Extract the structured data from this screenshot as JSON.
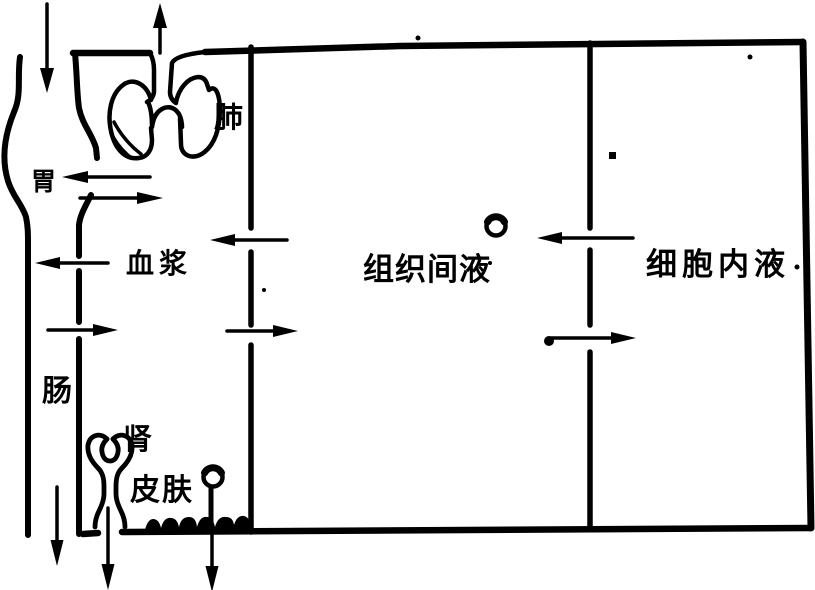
{
  "diagram": {
    "colors": {
      "ink": "#000000",
      "background": "#ffffff"
    },
    "compartments": [
      {
        "id": "plasma",
        "label": "血浆"
      },
      {
        "id": "interstitial",
        "label": "组织间液"
      },
      {
        "id": "intracellular",
        "label": "细胞内液"
      }
    ],
    "organs": [
      {
        "id": "lung",
        "label": "肺"
      },
      {
        "id": "stomach",
        "label": "胃"
      },
      {
        "id": "intestine",
        "label": "肠"
      },
      {
        "id": "kidney",
        "label": "肾"
      },
      {
        "id": "skin",
        "label": "皮肤"
      }
    ],
    "flows": [
      {
        "name": "ingestion",
        "from": "outside",
        "to": "digestive-tract",
        "direction": "down"
      },
      {
        "name": "exhalation",
        "from": "lung",
        "to": "outside",
        "direction": "up"
      },
      {
        "name": "secretion-into-stomach",
        "from": "plasma",
        "to": "stomach",
        "direction": "left"
      },
      {
        "name": "absorption-from-stomach",
        "from": "stomach",
        "to": "plasma",
        "direction": "right"
      },
      {
        "name": "secretion-into-intestine",
        "from": "plasma",
        "to": "intestine",
        "direction": "left"
      },
      {
        "name": "absorption-from-intestine",
        "from": "intestine",
        "to": "plasma",
        "direction": "right"
      },
      {
        "name": "interstitial-to-plasma",
        "from": "interstitial",
        "to": "plasma",
        "direction": "left"
      },
      {
        "name": "plasma-to-interstitial",
        "from": "plasma",
        "to": "interstitial",
        "direction": "right"
      },
      {
        "name": "intracellular-to-interstitial",
        "from": "intracellular",
        "to": "interstitial",
        "direction": "left"
      },
      {
        "name": "interstitial-to-intracellular",
        "from": "interstitial",
        "to": "intracellular",
        "direction": "right"
      },
      {
        "name": "defecation",
        "from": "intestine",
        "to": "outside",
        "direction": "down"
      },
      {
        "name": "urination",
        "from": "kidney",
        "to": "outside",
        "direction": "down"
      },
      {
        "name": "perspiration",
        "from": "skin",
        "to": "outside",
        "direction": "down"
      }
    ]
  }
}
